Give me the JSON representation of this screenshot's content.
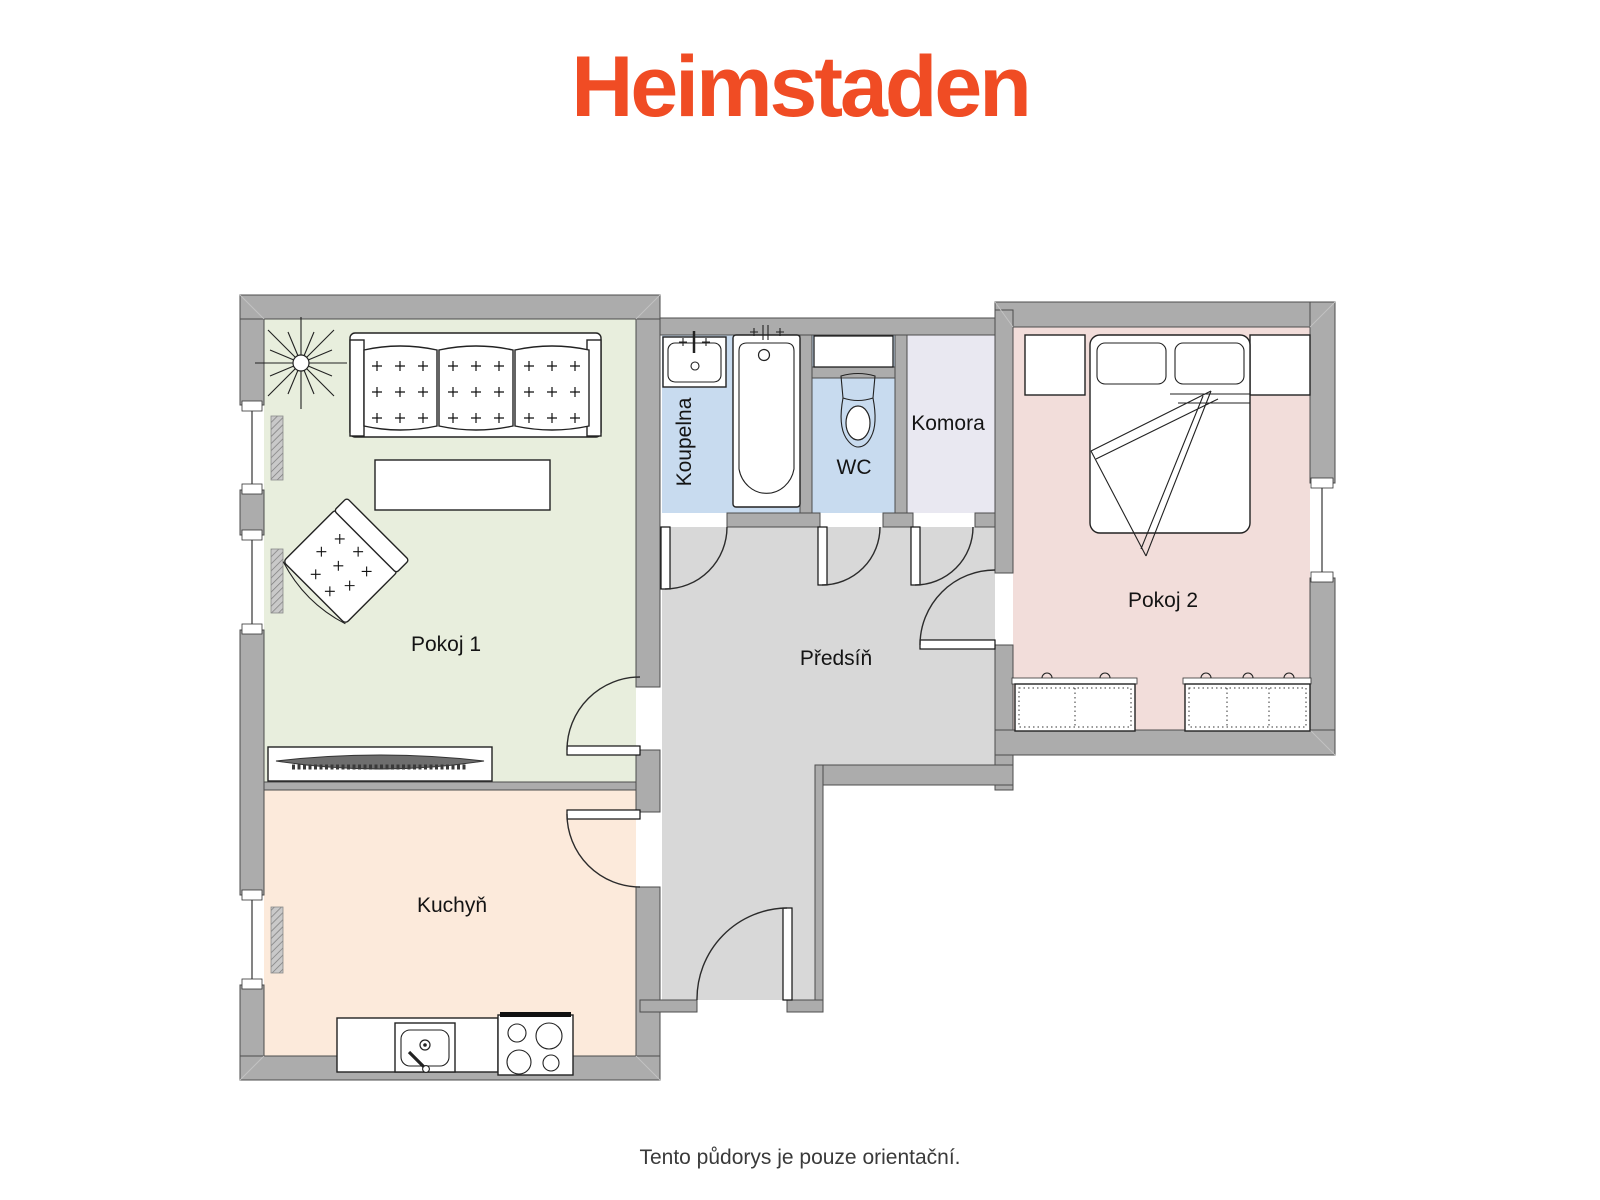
{
  "brand": {
    "logo_text": "Heimstaden",
    "logo_color": "#F04C24"
  },
  "footer": {
    "disclaimer": "Tento půdorys je pouze orientační."
  },
  "floorplan": {
    "wall_color": "#ACACAC",
    "rooms": [
      {
        "id": "pokoj-1",
        "label": "Pokoj 1",
        "floor_color": "#E8EEDD",
        "furniture": [
          "sofa",
          "coffee-table",
          "armchair",
          "plant",
          "tv-lowboard",
          "radiator",
          "window",
          "window"
        ]
      },
      {
        "id": "kuchyn",
        "label": "Kuchyň",
        "floor_color": "#FCEADB",
        "furniture": [
          "kitchen-counter",
          "kitchen-sink",
          "stove",
          "radiator",
          "window"
        ]
      },
      {
        "id": "koupelna",
        "label": "Koupelna",
        "floor_color": "#C8DBEF",
        "furniture": [
          "washbasin",
          "bathtub"
        ]
      },
      {
        "id": "wc",
        "label": "WC",
        "floor_color": "#C8DBEF",
        "furniture": [
          "toilet",
          "duct-box"
        ]
      },
      {
        "id": "komora",
        "label": "Komora",
        "floor_color": "#E9E8F1",
        "furniture": []
      },
      {
        "id": "predsin",
        "label": "Předsíň",
        "floor_color": "#D8D8D8",
        "furniture": [
          "entrance-door"
        ]
      },
      {
        "id": "pokoj-2",
        "label": "Pokoj 2",
        "floor_color": "#F2DDDA",
        "furniture": [
          "double-bed",
          "wardrobe",
          "wardrobe",
          "dresser-2-door",
          "dresser-3-door",
          "window"
        ]
      }
    ]
  }
}
